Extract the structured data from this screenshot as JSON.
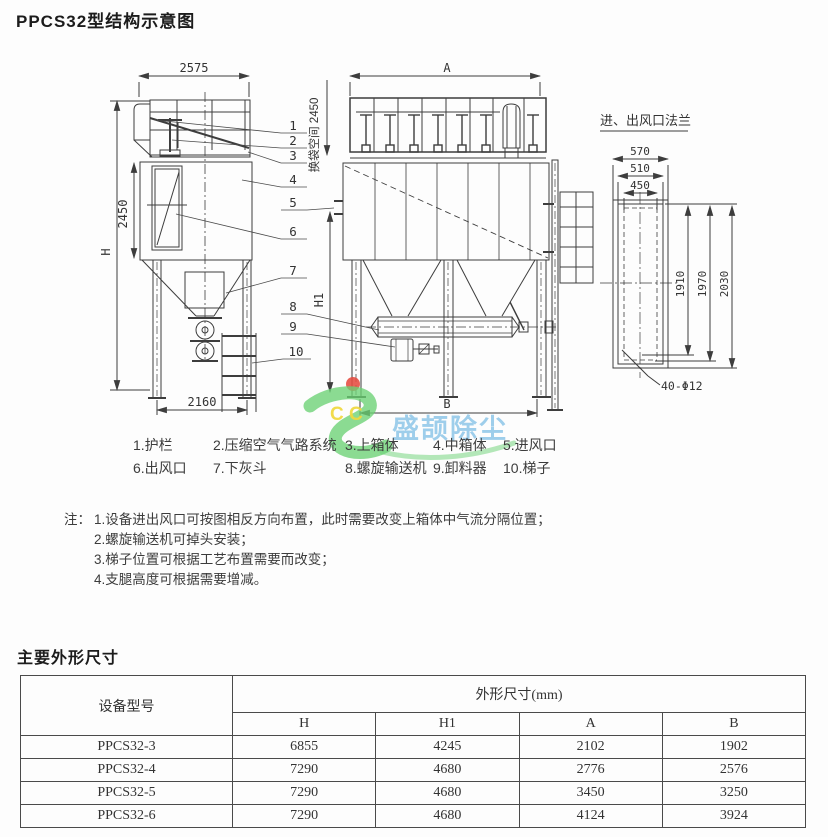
{
  "page_title": "PPCS32型结构示意图",
  "diagram": {
    "left_view": {
      "dim_top": "2575",
      "dim_bag_height": "2450",
      "dim_total_height": "H",
      "dim_base": "2160"
    },
    "middle_view": {
      "dim_top": "A",
      "dim_h1": "H1",
      "dim_base": "B",
      "bag_space_label": "换袋空间 2450"
    },
    "flange_view": {
      "title": "进、出风口法兰",
      "dim_570": "570",
      "dim_510": "510",
      "dim_450": "450",
      "dim_1910": "1910",
      "dim_1970": "1970",
      "dim_2030": "2030",
      "bolt_label": "40-Φ12"
    },
    "callouts": [
      "1",
      "2",
      "3",
      "4",
      "5",
      "6",
      "7",
      "8",
      "9",
      "10"
    ],
    "watermark": {
      "letters": "C C",
      "brand": "盛颉除尘",
      "green": "#6ad173",
      "yellow": "#f0d93e",
      "red": "#e54b40",
      "blue": "#8ec6e8"
    }
  },
  "legend": {
    "row1": [
      "1.护栏",
      "2.压缩空气气路系统",
      "3.上箱体",
      "4.中箱体",
      "5.进风口"
    ],
    "row2": [
      "6.出风口",
      "7.下灰斗",
      "8.螺旋输送机",
      "9.卸料器",
      "10.梯子"
    ]
  },
  "notes": {
    "label": "注：",
    "items": [
      "1.设备进出风口可按图相反方向布置，此时需要改变上箱体中气流分隔位置；",
      "2.螺旋输送机可掉头安装；",
      "3.梯子位置可根据工艺布置需要而改变；",
      "4.支腿高度可根据需要增减。"
    ]
  },
  "dimensions_table": {
    "heading": "主要外形尺寸",
    "model_header": "设备型号",
    "group_header": "外形尺寸(mm)",
    "columns": [
      "H",
      "H1",
      "A",
      "B"
    ],
    "rows": [
      {
        "model": "PPCS32-3",
        "h": "6855",
        "h1": "4245",
        "a": "2102",
        "b": "1902"
      },
      {
        "model": "PPCS32-4",
        "h": "7290",
        "h1": "4680",
        "a": "2776",
        "b": "2576"
      },
      {
        "model": "PPCS32-5",
        "h": "7290",
        "h1": "4680",
        "a": "3450",
        "b": "3250"
      },
      {
        "model": "PPCS32-6",
        "h": "7290",
        "h1": "4680",
        "a": "4124",
        "b": "3924"
      }
    ]
  }
}
